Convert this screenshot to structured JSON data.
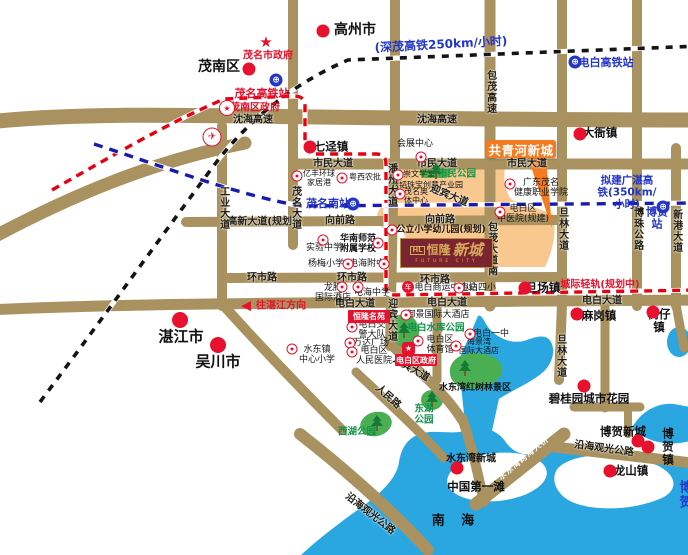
{
  "colors": {
    "road": "#a9925f",
    "water": "#2aa7e0",
    "zone": "#f9c88f",
    "callout": "#f47b20",
    "logo_bg": "#7a2431",
    "logo_gold": "#d8ab5a",
    "red": "#e8112d",
    "blue": "#2336c8",
    "green_text": "#0f9347",
    "park": "#4aae52",
    "rail_red": "#e60012",
    "rail_blue": "#1a1aae",
    "rail_black": "#141414"
  },
  "project": {
    "callout": "共青河新城",
    "logo_mark": "HL",
    "logo_cn_1": "恒隆",
    "logo_cn_2": "新城",
    "logo_en": "FUTURE CITY",
    "residence_box": "恒隆名苑",
    "government_box": "电白区政府",
    "government_star": "★"
  },
  "map": {
    "labels": [
      {
        "n": "gaozhou-city",
        "t": "高州市",
        "x": 355,
        "y": 31,
        "c": "city"
      },
      {
        "n": "maonan-district",
        "t": "茂南区",
        "x": 219,
        "y": 68,
        "c": "city"
      },
      {
        "n": "zhanjiang-city",
        "t": "湛江市",
        "x": 181,
        "y": 337,
        "c": "cityL"
      },
      {
        "n": "wuchuan-city",
        "t": "吴川市",
        "x": 218,
        "y": 362,
        "c": "cityL"
      },
      {
        "n": "south-china-sea",
        "t": "南 海",
        "x": 456,
        "y": 522,
        "c": "sea"
      },
      {
        "n": "shenmao-hsr-label",
        "t": "(深茂高铁250km/小时)",
        "x": 441,
        "y": 45,
        "c": "blueL",
        "r": -3
      },
      {
        "n": "guangzhan-hsr-label",
        "t": "拟建广湛高铁(350km/小时)",
        "x": 627,
        "y": 193,
        "c": "blueM"
      },
      {
        "n": "intercity-rail-label",
        "t": "城际轻轨(规划中)",
        "x": 600,
        "y": 285,
        "c": "red"
      },
      {
        "n": "dianbai-hsr-station-label",
        "t": "电白高铁站",
        "x": 606,
        "y": 63,
        "c": "blue"
      },
      {
        "n": "maoming-hsr-station-label",
        "t": "茂名高铁站",
        "x": 262,
        "y": 94,
        "c": "redB"
      },
      {
        "n": "maoming-south-station-label",
        "t": "茂名南站",
        "x": 328,
        "y": 204,
        "c": "blue"
      },
      {
        "n": "bohe-station-label",
        "t": "博贺站",
        "x": 657,
        "y": 219,
        "c": "blue"
      },
      {
        "n": "maoming-gov-label",
        "t": "茂名市政府",
        "x": 268,
        "y": 56,
        "c": "red"
      },
      {
        "n": "maonan-gov-label",
        "t": "茂南区政府",
        "x": 255,
        "y": 108,
        "c": "red"
      },
      {
        "n": "to-zhanjiang-label",
        "t": "往湛江方向",
        "x": 281,
        "y": 306,
        "c": "red"
      },
      {
        "t": "沈海高速",
        "x": 253,
        "y": 120,
        "c": "road"
      },
      {
        "t": "沈海高速",
        "x": 437,
        "y": 120,
        "c": "road"
      },
      {
        "t": "市民大道",
        "x": 333,
        "y": 164,
        "c": "road"
      },
      {
        "t": "市民大道",
        "x": 437,
        "y": 164,
        "c": "road"
      },
      {
        "t": "市民大道",
        "x": 527,
        "y": 164,
        "c": "road"
      },
      {
        "t": "高新大道(规划)",
        "x": 262,
        "y": 222,
        "c": "road"
      },
      {
        "t": "向前路",
        "x": 340,
        "y": 221,
        "c": "road"
      },
      {
        "t": "向前路",
        "x": 440,
        "y": 220,
        "c": "road"
      },
      {
        "t": "环市路",
        "x": 262,
        "y": 278,
        "c": "road"
      },
      {
        "t": "环市路",
        "x": 352,
        "y": 278,
        "c": "road"
      },
      {
        "t": "环市路",
        "x": 435,
        "y": 280,
        "c": "road"
      },
      {
        "t": "电白大道",
        "x": 355,
        "y": 304,
        "c": "road"
      },
      {
        "t": "电白大道",
        "x": 447,
        "y": 303,
        "c": "road"
      },
      {
        "t": "电白大道",
        "x": 602,
        "y": 301,
        "c": "road"
      },
      {
        "t": "沿海观光公路",
        "x": 370,
        "y": 514,
        "c": "road",
        "r": 38
      },
      {
        "t": "沿海观光公路",
        "x": 604,
        "y": 449,
        "c": "road",
        "r": 8
      },
      {
        "t": "人民路",
        "x": 388,
        "y": 397,
        "c": "road",
        "r": 42
      },
      {
        "t": "迎宾大道",
        "x": 449,
        "y": 196,
        "c": "road",
        "r": 22
      },
      {
        "t": "迎宾大道",
        "x": 411,
        "y": 369,
        "c": "road",
        "r": 30
      },
      {
        "t": "包茂高速",
        "x": 490,
        "y": 92,
        "c": "roadv"
      },
      {
        "t": "包茂大道南",
        "x": 491,
        "y": 249,
        "c": "roadv"
      },
      {
        "t": "潘州大道",
        "x": 391,
        "y": 185,
        "c": "roadv"
      },
      {
        "t": "工业大道",
        "x": 223,
        "y": 208,
        "c": "roadv"
      },
      {
        "t": "茂名大道",
        "x": 295,
        "y": 208,
        "c": "roadv"
      },
      {
        "t": "旦林大道",
        "x": 562,
        "y": 229,
        "c": "roadv"
      },
      {
        "t": "旦林大道",
        "x": 560,
        "y": 356,
        "c": "roadv"
      },
      {
        "t": "博珠公路",
        "x": 637,
        "y": 229,
        "c": "roadv"
      },
      {
        "t": "新港大道",
        "x": 676,
        "y": 231,
        "c": "roadv"
      },
      {
        "t": "迎宾大道",
        "x": 391,
        "y": 320,
        "c": "roadv"
      },
      {
        "n": "shuidongwan-bridge-label",
        "t": "水东湾跨海大桥",
        "x": 524,
        "y": 459,
        "c": "bridge",
        "r": -40
      },
      {
        "t": "会展中心",
        "x": 415,
        "y": 144,
        "c": "poi"
      },
      {
        "n": "citizen-park-label",
        "t": "市民公园",
        "x": 457,
        "y": 175,
        "c": "green"
      },
      {
        "t": "崇文学堂",
        "x": 419,
        "y": 175,
        "c": "poiS"
      },
      {
        "t": "六韬珠宝创意产业园",
        "x": 427,
        "y": 186,
        "c": "poiS"
      },
      {
        "t": "茂名奥\n体中心",
        "x": 416,
        "y": 197,
        "c": "poiS"
      },
      {
        "t": "亿丰环球\n家居港",
        "x": 319,
        "y": 179,
        "c": "poiS"
      },
      {
        "t": "粤西农批",
        "x": 365,
        "y": 178,
        "c": "poiS"
      },
      {
        "t": "广东茂名\n健康职业学院",
        "x": 541,
        "y": 188,
        "c": "poi"
      },
      {
        "t": "电白区\n中医院(规建)",
        "x": 523,
        "y": 214,
        "c": "poi"
      },
      {
        "t": "公立小学幼儿园(规划)",
        "x": 441,
        "y": 230,
        "c": "poib"
      },
      {
        "t": "实验中学",
        "x": 324,
        "y": 248,
        "c": "poi"
      },
      {
        "t": "华南师范\n附属学校",
        "x": 358,
        "y": 244,
        "c": "poib"
      },
      {
        "t": "杨梅小学",
        "x": 326,
        "y": 264,
        "c": "poi"
      },
      {
        "t": "电海附中",
        "x": 367,
        "y": 264,
        "c": "poi"
      },
      {
        "t": "龙腾\n国际酒店",
        "x": 333,
        "y": 293,
        "c": "poi"
      },
      {
        "t": "电海中学",
        "x": 372,
        "y": 293,
        "c": "poi"
      },
      {
        "t": "电白商运中心站",
        "x": 446,
        "y": 288,
        "c": "poi"
      },
      {
        "t": "电白四小",
        "x": 478,
        "y": 288,
        "c": "poi"
      },
      {
        "t": "御景国际大酒店",
        "x": 438,
        "y": 315,
        "c": "poi"
      },
      {
        "t": "电白交\n警大队",
        "x": 372,
        "y": 330,
        "c": "poi"
      },
      {
        "t": "万达广场",
        "x": 371,
        "y": 343,
        "c": "poi"
      },
      {
        "t": "电白区\n人民医院",
        "x": 374,
        "y": 356,
        "c": "poi"
      },
      {
        "t": "水东镇\n中心小学",
        "x": 317,
        "y": 355,
        "c": "poi"
      },
      {
        "n": "reservoir-park-label",
        "t": "电白水库公园",
        "x": 436,
        "y": 329,
        "c": "green"
      },
      {
        "t": "电白区\n体育馆",
        "x": 440,
        "y": 345,
        "c": "poi"
      },
      {
        "t": "电白一中",
        "x": 491,
        "y": 334,
        "c": "poi"
      },
      {
        "t": "海景湾\n国际大酒店",
        "x": 479,
        "y": 347,
        "c": "poiS"
      },
      {
        "n": "east-lake-park-label",
        "t": "东湖\n公园",
        "x": 424,
        "y": 415,
        "c": "green"
      },
      {
        "n": "west-lake-park-label",
        "t": "西湖公园",
        "x": 357,
        "y": 433,
        "c": "green"
      },
      {
        "n": "mangrove-reserve-label",
        "t": "水东湾红树林景区",
        "x": 475,
        "y": 388,
        "c": "poib"
      },
      {
        "t": "中国第一滩",
        "x": 476,
        "y": 487,
        "c": "town"
      },
      {
        "t": "七迳镇",
        "x": 331,
        "y": 147,
        "c": "town"
      },
      {
        "t": "大衙镇",
        "x": 600,
        "y": 133,
        "c": "town"
      },
      {
        "t": "旦场镇",
        "x": 543,
        "y": 288,
        "c": "town"
      },
      {
        "t": "麻岗镇",
        "x": 599,
        "y": 316,
        "c": "town"
      },
      {
        "t": "树仔镇",
        "x": 659,
        "y": 321,
        "c": "town"
      },
      {
        "t": "博贺新城",
        "x": 623,
        "y": 432,
        "c": "town"
      },
      {
        "t": "博贺镇",
        "x": 668,
        "y": 447,
        "c": "town"
      },
      {
        "t": "龙山镇",
        "x": 631,
        "y": 471,
        "c": "town"
      },
      {
        "t": "水东湾新城",
        "x": 471,
        "y": 459,
        "c": "townS"
      },
      {
        "t": "碧桂园城市花园",
        "x": 589,
        "y": 399,
        "c": "town"
      },
      {
        "n": "bohe-edge-label",
        "t": "博贺",
        "x": 686,
        "y": 496,
        "c": "blueP"
      }
    ],
    "icons": [
      {
        "t": "dot",
        "x": 323,
        "y": 31
      },
      {
        "t": "dot",
        "x": 249,
        "y": 69
      },
      {
        "t": "dot",
        "x": 310,
        "y": 147
      },
      {
        "t": "dot",
        "x": 580,
        "y": 134
      },
      {
        "t": "dotL",
        "x": 180,
        "y": 320
      },
      {
        "t": "dotL",
        "x": 218,
        "y": 345
      },
      {
        "t": "dot",
        "x": 525,
        "y": 288
      },
      {
        "t": "dot",
        "x": 577,
        "y": 314
      },
      {
        "t": "dot",
        "x": 653,
        "y": 312
      },
      {
        "t": "dot",
        "x": 638,
        "y": 441
      },
      {
        "t": "dot",
        "x": 648,
        "y": 447
      },
      {
        "t": "dot",
        "x": 610,
        "y": 471
      },
      {
        "t": "dot",
        "x": 457,
        "y": 468
      },
      {
        "t": "dot",
        "x": 584,
        "y": 386
      },
      {
        "t": "star",
        "x": 266,
        "y": 42
      },
      {
        "t": "starCircle",
        "x": 227,
        "y": 108
      },
      {
        "t": "station",
        "x": 276,
        "y": 80
      },
      {
        "t": "station",
        "x": 575,
        "y": 62
      },
      {
        "t": "station",
        "x": 353,
        "y": 204
      },
      {
        "t": "station",
        "x": 663,
        "y": 207
      },
      {
        "t": "airport",
        "x": 212,
        "y": 137
      },
      {
        "t": "poiIcon",
        "x": 421,
        "y": 157
      },
      {
        "t": "poiIcon",
        "x": 398,
        "y": 175
      },
      {
        "t": "poiIcon",
        "x": 400,
        "y": 194
      },
      {
        "t": "poiIcon",
        "x": 297,
        "y": 176
      },
      {
        "t": "poiIcon",
        "x": 342,
        "y": 178
      },
      {
        "t": "poiIcon",
        "x": 510,
        "y": 184
      },
      {
        "t": "poiIcon",
        "x": 500,
        "y": 212
      },
      {
        "t": "poiIcon",
        "x": 392,
        "y": 230
      },
      {
        "t": "poiIcon",
        "x": 323,
        "y": 240
      },
      {
        "t": "poiIcon",
        "x": 378,
        "y": 243
      },
      {
        "t": "poiIcon",
        "x": 348,
        "y": 264
      },
      {
        "t": "poiIcon",
        "x": 384,
        "y": 264
      },
      {
        "t": "poiIcon",
        "x": 342,
        "y": 287
      },
      {
        "t": "poiIcon",
        "x": 358,
        "y": 287
      },
      {
        "t": "bus",
        "x": 408,
        "y": 287
      },
      {
        "t": "poiIcon",
        "x": 459,
        "y": 288
      },
      {
        "t": "poiIcon",
        "x": 406,
        "y": 315
      },
      {
        "t": "poiIcon",
        "x": 352,
        "y": 327
      },
      {
        "t": "poiIcon",
        "x": 350,
        "y": 343
      },
      {
        "t": "poiIcon",
        "x": 352,
        "y": 352
      },
      {
        "t": "poiIcon",
        "x": 292,
        "y": 349
      },
      {
        "t": "poiIcon",
        "x": 418,
        "y": 341
      },
      {
        "t": "poiIcon",
        "x": 470,
        "y": 334
      },
      {
        "t": "poiIcon",
        "x": 456,
        "y": 346
      },
      {
        "t": "tree",
        "x": 436,
        "y": 171
      },
      {
        "t": "tree",
        "x": 404,
        "y": 330
      },
      {
        "t": "tree",
        "x": 432,
        "y": 399
      },
      {
        "t": "tree",
        "x": 377,
        "y": 423
      },
      {
        "t": "tree",
        "x": 465,
        "y": 368
      },
      {
        "t": "arrowLeft",
        "x": 246,
        "y": 306
      }
    ]
  }
}
